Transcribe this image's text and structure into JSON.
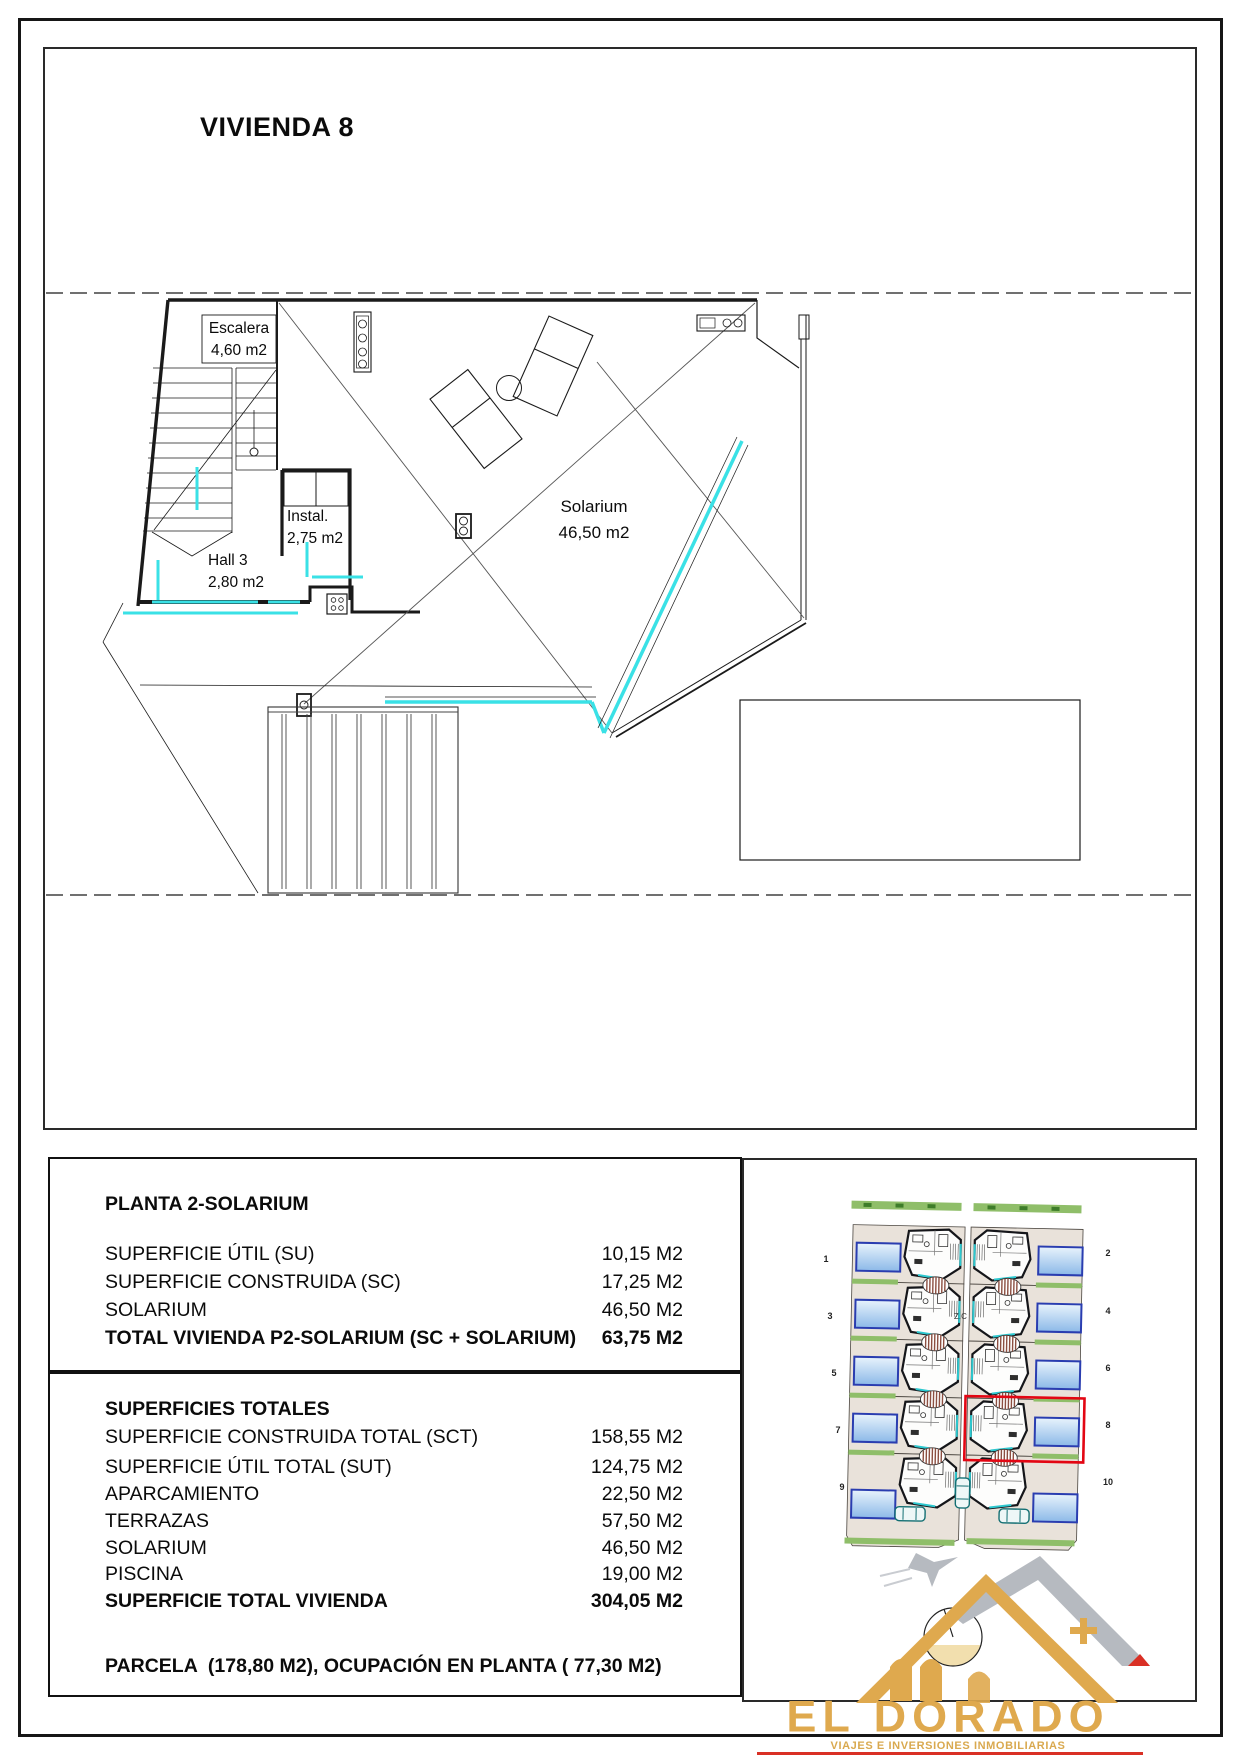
{
  "page": {
    "title": "VIVIENDA 8"
  },
  "plan": {
    "labels": {
      "escalera": {
        "line1": "Escalera",
        "line2": "4,60 m2"
      },
      "instal": {
        "line1": "Instal.",
        "line2": "2,75 m2"
      },
      "hall": {
        "line1": "Hall 3",
        "line2": "2,80 m2"
      },
      "solarium": {
        "line1": "Solarium",
        "line2": "46,50 m2"
      }
    }
  },
  "tables": {
    "planta": {
      "title": "PLANTA 2-SOLARIUM",
      "rows": [
        {
          "label": "SUPERFICIE ÚTIL (SU)",
          "value": "10,15 M2"
        },
        {
          "label": "SUPERFICIE CONSTRUIDA (SC)",
          "value": "17,25 M2"
        },
        {
          "label": "SOLARIUM",
          "value": "46,50 M2"
        }
      ],
      "total": {
        "label": "TOTAL VIVIENDA P2-SOLARIUM (SC + SOLARIUM)",
        "value": "63,75 M2"
      }
    },
    "totales": {
      "title": "SUPERFICIES TOTALES",
      "rows": [
        {
          "label": "SUPERFICIE CONSTRUIDA TOTAL (SCT)",
          "value": "158,55 M2"
        },
        {
          "label": "SUPERFICIE ÚTIL TOTAL (SUT)",
          "value": "124,75 M2"
        },
        {
          "label": "APARCAMIENTO",
          "value": "22,50 M2"
        },
        {
          "label": "TERRAZAS",
          "value": "57,50 M2"
        },
        {
          "label": "SOLARIUM",
          "value": "46,50 M2"
        },
        {
          "label": "PISCINA",
          "value": "19,00 M2"
        }
      ],
      "total": {
        "label": "SUPERFICIE TOTAL VIVIENDA",
        "value": "304,05 M2"
      },
      "footer": "PARCELA  (178,80 M2), OCUPACIÓN EN PLANTA ( 77,30 M2)"
    }
  },
  "site": {
    "units": [
      "1",
      "2",
      "3",
      "4",
      "5",
      "6",
      "7",
      "8",
      "9",
      "10"
    ],
    "zone_label": "Z.C",
    "highlighted_unit": "8",
    "highlight_color": "#e30613"
  },
  "logo": {
    "name": "EL DORADO",
    "tagline": "VIAJES E INVERSIONES INMOBILIARIAS",
    "gold": "#dfa94e"
  },
  "colors": {
    "glass_cyan": "#3ae1e6",
    "pool_border": "#2a3db0",
    "green": "#8fbe69",
    "plot_beige": "#e9e2da"
  }
}
